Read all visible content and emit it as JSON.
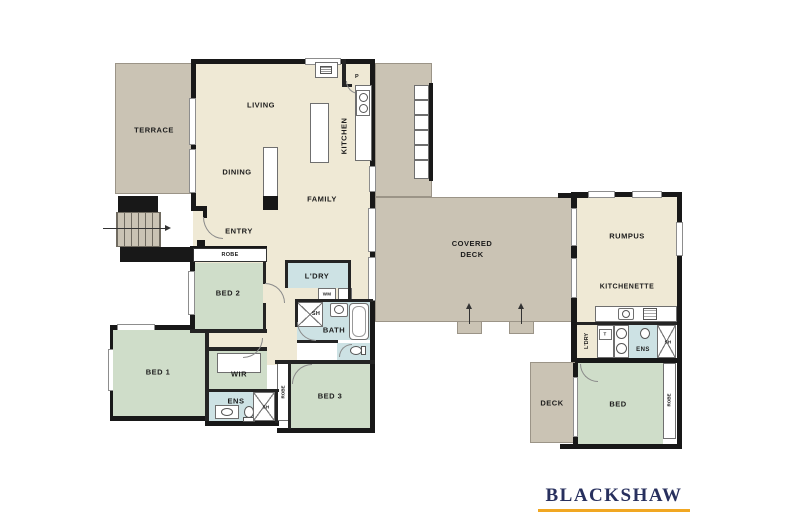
{
  "brand": {
    "name": "BLACKSHAW",
    "navy": "#28305e",
    "gold": "#f1a722"
  },
  "palette": {
    "floor_cream": "#efe9d5",
    "deck_taupe": "#cac3b4",
    "bedroom_green": "#cfddc9",
    "wet_area_blue": "#cde2e4",
    "wall_black": "#181818"
  },
  "floorplan": {
    "main_level": {
      "terrace": "TERRACE",
      "living": "LIVING",
      "dining": "DINING",
      "kitchen": "KITCHEN",
      "family": "FAMILY",
      "entry": "ENTRY",
      "pantry": "P",
      "robe_bed2": "ROBE",
      "bed2": "BED 2",
      "laundry": "L'DRY",
      "washing_machine": "WM",
      "bath": "BATH",
      "bath_shower": "SH",
      "covered_deck": [
        "COVERED",
        "DECK"
      ],
      "bed1": "BED 1",
      "wir": "WIR",
      "ensuite": "ENS",
      "ensuite_shower": "SH",
      "hall_robe": "ROBE",
      "bed3": "BED 3"
    },
    "wing": {
      "rumpus": "RUMPUS",
      "kitchenette": "KITCHENETTE",
      "laundry": "L'DRY",
      "trough": "T",
      "ensuite": "ENS",
      "shower": "SH",
      "deck": "DECK",
      "bed": "BED",
      "robe": "ROBE"
    }
  }
}
